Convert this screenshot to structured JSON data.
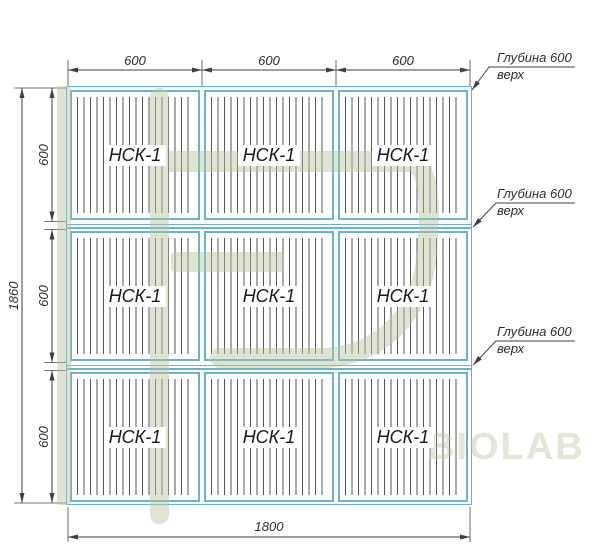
{
  "panels": {
    "label": "НСК-1",
    "count": 9
  },
  "dimensions": {
    "top": [
      "600",
      "600",
      "600"
    ],
    "left_rows": [
      "600",
      "600",
      "600"
    ],
    "left_total": "1860",
    "bottom": "1800"
  },
  "callouts": [
    {
      "line1": "Глубина 600",
      "line2": "верх"
    },
    {
      "line1": "Глубина 600",
      "line2": "верх"
    },
    {
      "line1": "Глубина 600",
      "line2": "верх"
    }
  ],
  "watermark": {
    "text": "BIOLAB",
    "color": "#b7c29c"
  },
  "colors": {
    "panel_frame": "#68b4cd",
    "drawing_line": "#3f3f3f",
    "hatch": "#54545e",
    "background": "#ffffff"
  }
}
